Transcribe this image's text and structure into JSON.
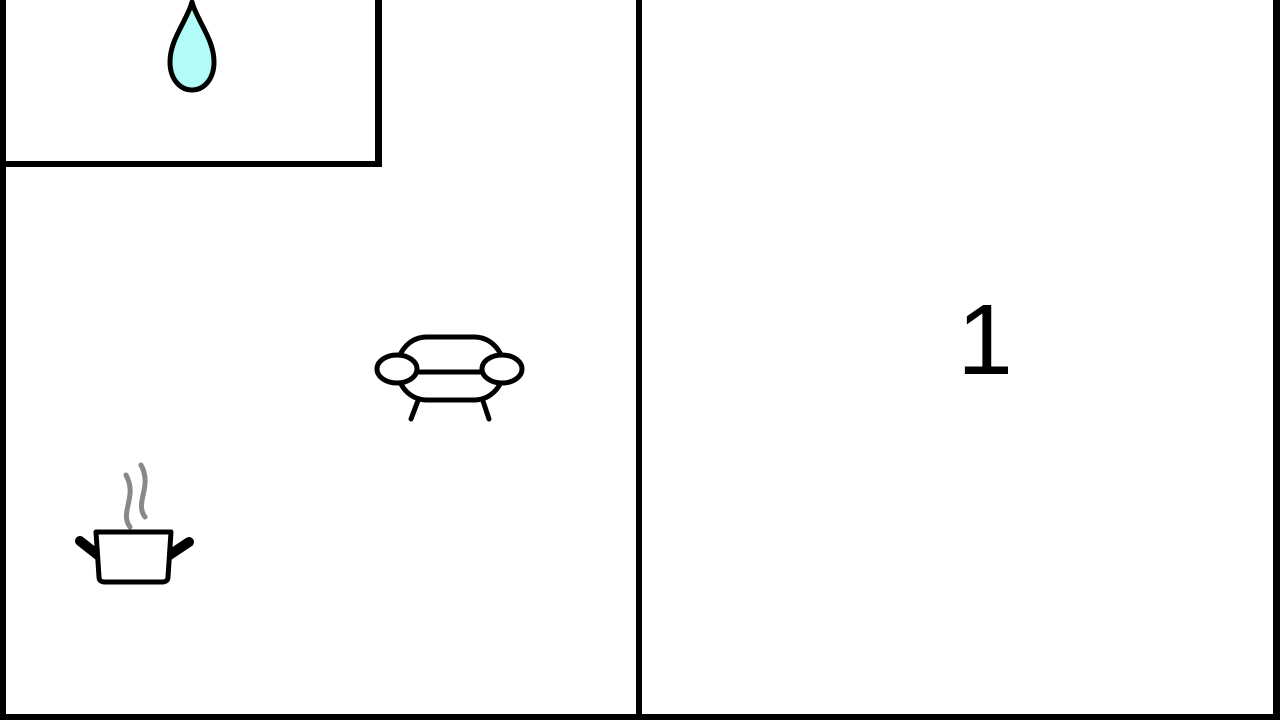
{
  "colors": {
    "wall": "#000000",
    "background": "#ffffff",
    "icon_stroke": "#000000",
    "droplet_fill": "#b2fcf8",
    "steam_gray": "#888888",
    "label_color": "#000000"
  },
  "floorplan": {
    "room_label": "1",
    "icons": [
      {
        "name": "water-drop-icon"
      },
      {
        "name": "sofa-icon"
      },
      {
        "name": "cooking-pot-icon"
      }
    ]
  }
}
